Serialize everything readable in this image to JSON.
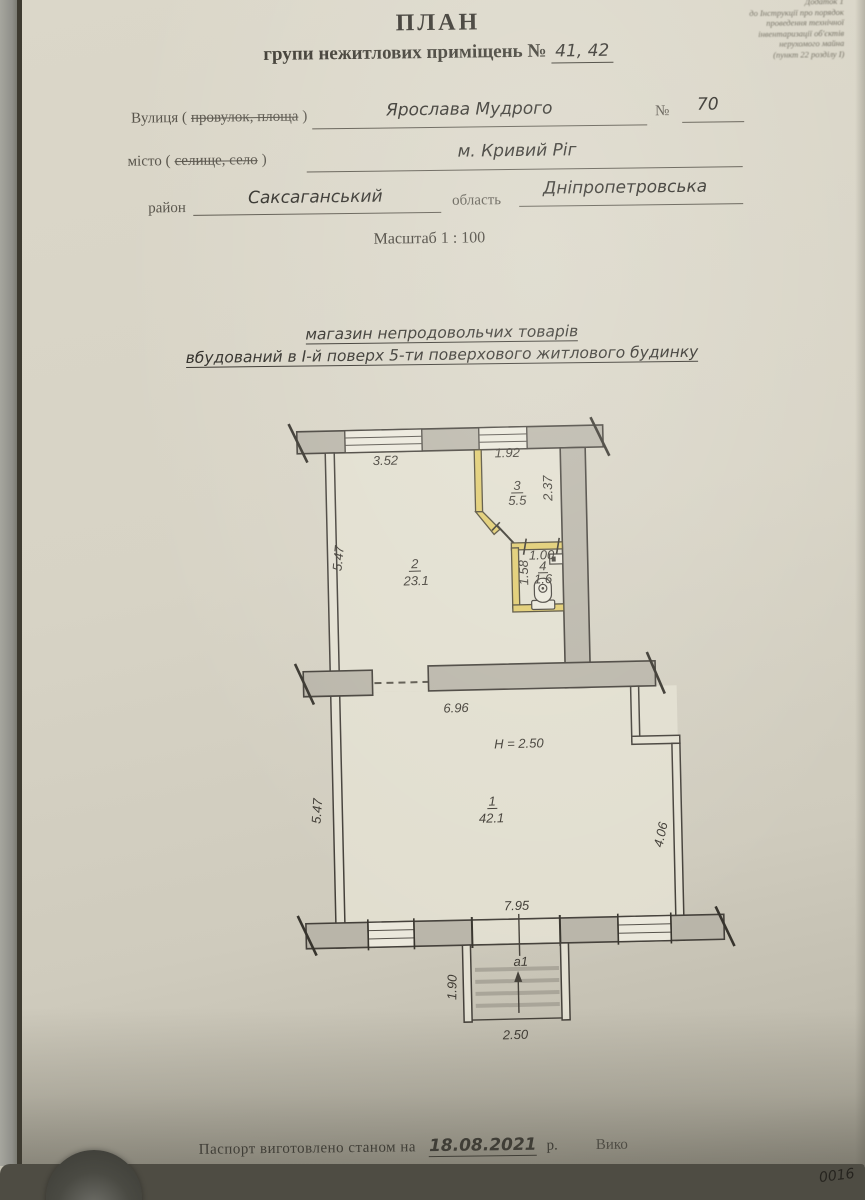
{
  "fineprint": [
    "Додаток 1",
    "до Інструкції про порядок",
    "проведення технічної",
    "інвентаризації об'єктів",
    "нерухомого майна",
    "(пункт 22 розділу І)"
  ],
  "title": {
    "main": "ПЛАН",
    "sub_prefix": "групи нежитлових приміщень №",
    "sub_value": "41, 42"
  },
  "form": {
    "street_label_a": "Вулиця (",
    "street_label_struck": "провулок, площа",
    "street_label_b": ")",
    "street_value": "Ярослава Мудрого",
    "number_label": "№",
    "number_value": "70",
    "city_label_a": "місто (",
    "city_label_struck": "селище, село",
    "city_label_b": ")",
    "city_value": "м. Кривий Ріг",
    "district_label": "район",
    "district_value": "Саксаганський",
    "region_label": "область",
    "region_value": "Дніпропетровська",
    "scale": "Масштаб 1 : 100"
  },
  "subject": {
    "line1": "магазин непродовольчих товарів",
    "line2": "вбудований в І-й поверх 5-ти поверхового житлового будинку"
  },
  "plan": {
    "dim_top_left_window": "3.52",
    "dim_top_right_window": "1.92",
    "dim_room3_height": "2.37",
    "dim_left_upper": "5.47",
    "dim_room4_width": "1.00",
    "dim_room4_depth": "1.58",
    "dim_mid_wall": "6.96",
    "ceiling_height": "H = 2.50",
    "dim_left_lower": "5.47",
    "dim_right_lower": "4.06",
    "dim_bottom": "7.95",
    "stair_label": "а1",
    "stair_depth": "1.90",
    "stair_width": "2.50",
    "rooms": [
      {
        "num": "1",
        "area": "42.1"
      },
      {
        "num": "2",
        "area": "23.1"
      },
      {
        "num": "3",
        "area": "5.5"
      },
      {
        "num": "4",
        "area": "1.6"
      }
    ]
  },
  "footer": {
    "prefix": "Паспорт виготовлено станом на",
    "date": "18.08.2021",
    "suffix": "р.",
    "partial": "Вико",
    "corner_number": "0016"
  }
}
